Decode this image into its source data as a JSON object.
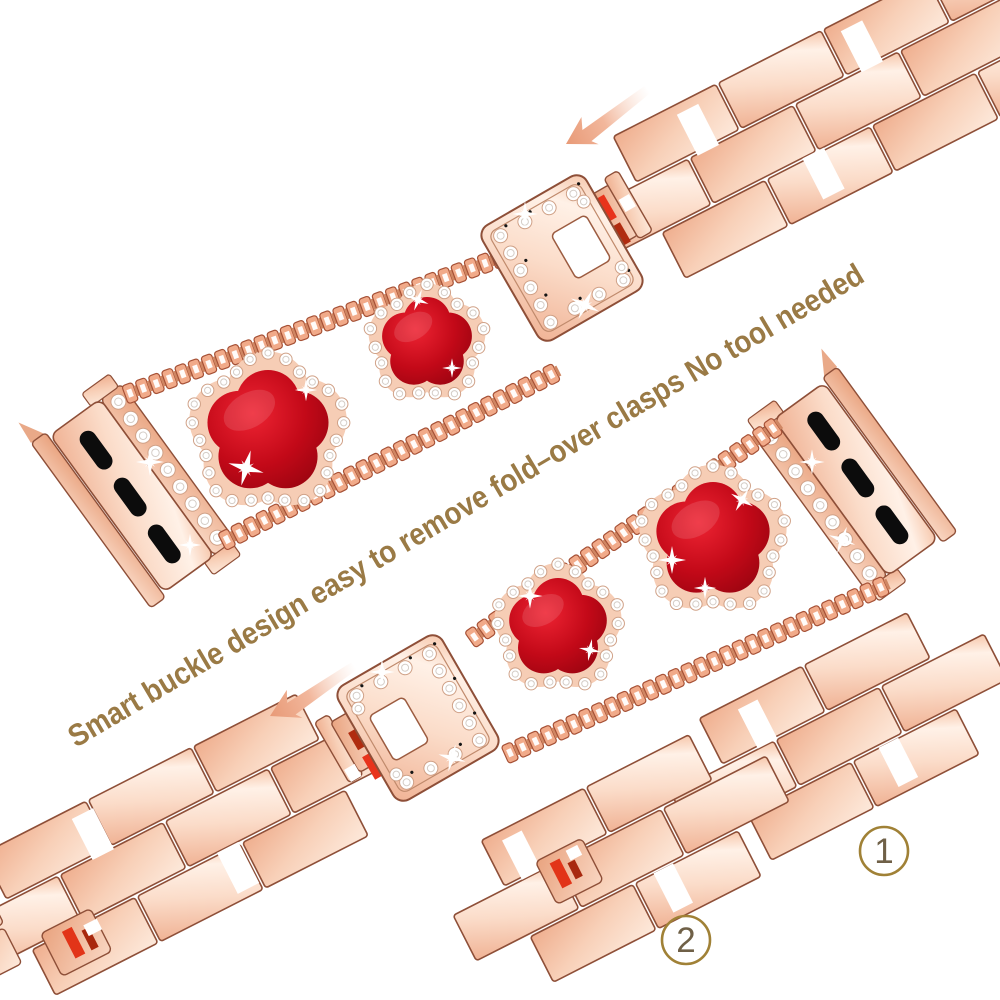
{
  "slogan": {
    "text": "Smart buckle design easy to remove fold–over clasps No tool needed",
    "color": "#9a7a45"
  },
  "steps": [
    {
      "label": "1"
    },
    {
      "label": "2"
    }
  ],
  "icons": {
    "arrow_top": "arrow-down-left",
    "arrow_middle": "arrow-down-left"
  },
  "colors": {
    "background": "#ffffff",
    "rose_gold": "#f3b797",
    "rose_gold_deep": "#e9a37f",
    "outline_brown": "#8e4f38",
    "clover_red": "#c30918",
    "diamond": "#ffffff",
    "arrow_salmon": "#eda684",
    "step_circle": "#a08136",
    "step_number": "#6f6047",
    "slot_black": "#0c0c0c"
  }
}
